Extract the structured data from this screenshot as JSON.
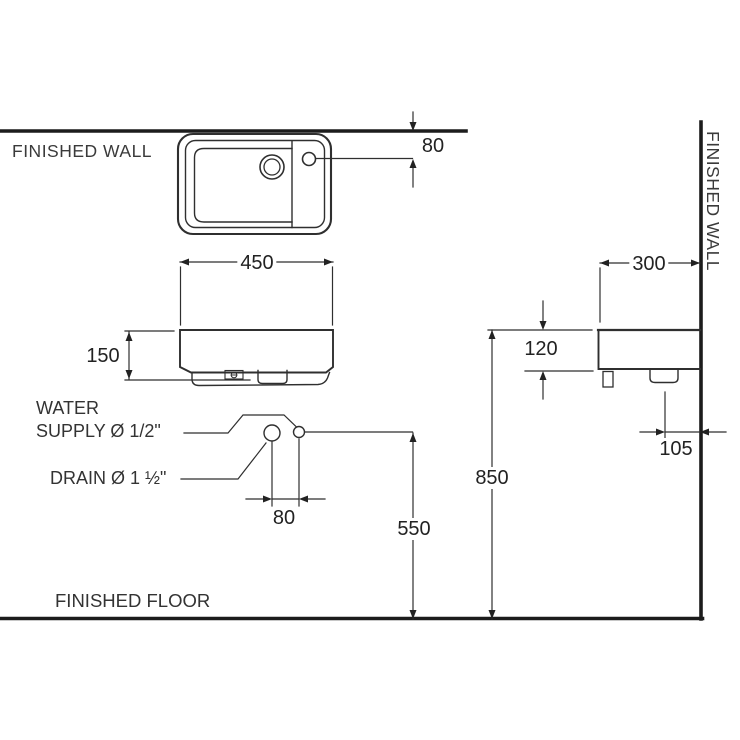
{
  "labels": {
    "finished_wall_top": "FINISHED WALL",
    "finished_wall_right": "FINISHED WALL",
    "finished_floor": "FINISHED FLOOR",
    "water_supply_line1": "WATER",
    "water_supply_line2": "SUPPLY Ø 1/2\"",
    "drain": "DRAIN Ø 1 ½\""
  },
  "dims": {
    "faucet_offset_from_wall": "80",
    "basin_width": "450",
    "basin_front_height": "150",
    "supply_drain_spacing": "80",
    "supply_height_from_floor": "550",
    "rim_height_from_floor": "850",
    "basin_depth": "300",
    "side_body_height": "120",
    "drain_offset_from_wall": "105"
  },
  "colors": {
    "background": "#ffffff",
    "heavy_line": "#1c1c1c",
    "thin_line": "#2f2f2f",
    "text": "#2e2e2e"
  }
}
